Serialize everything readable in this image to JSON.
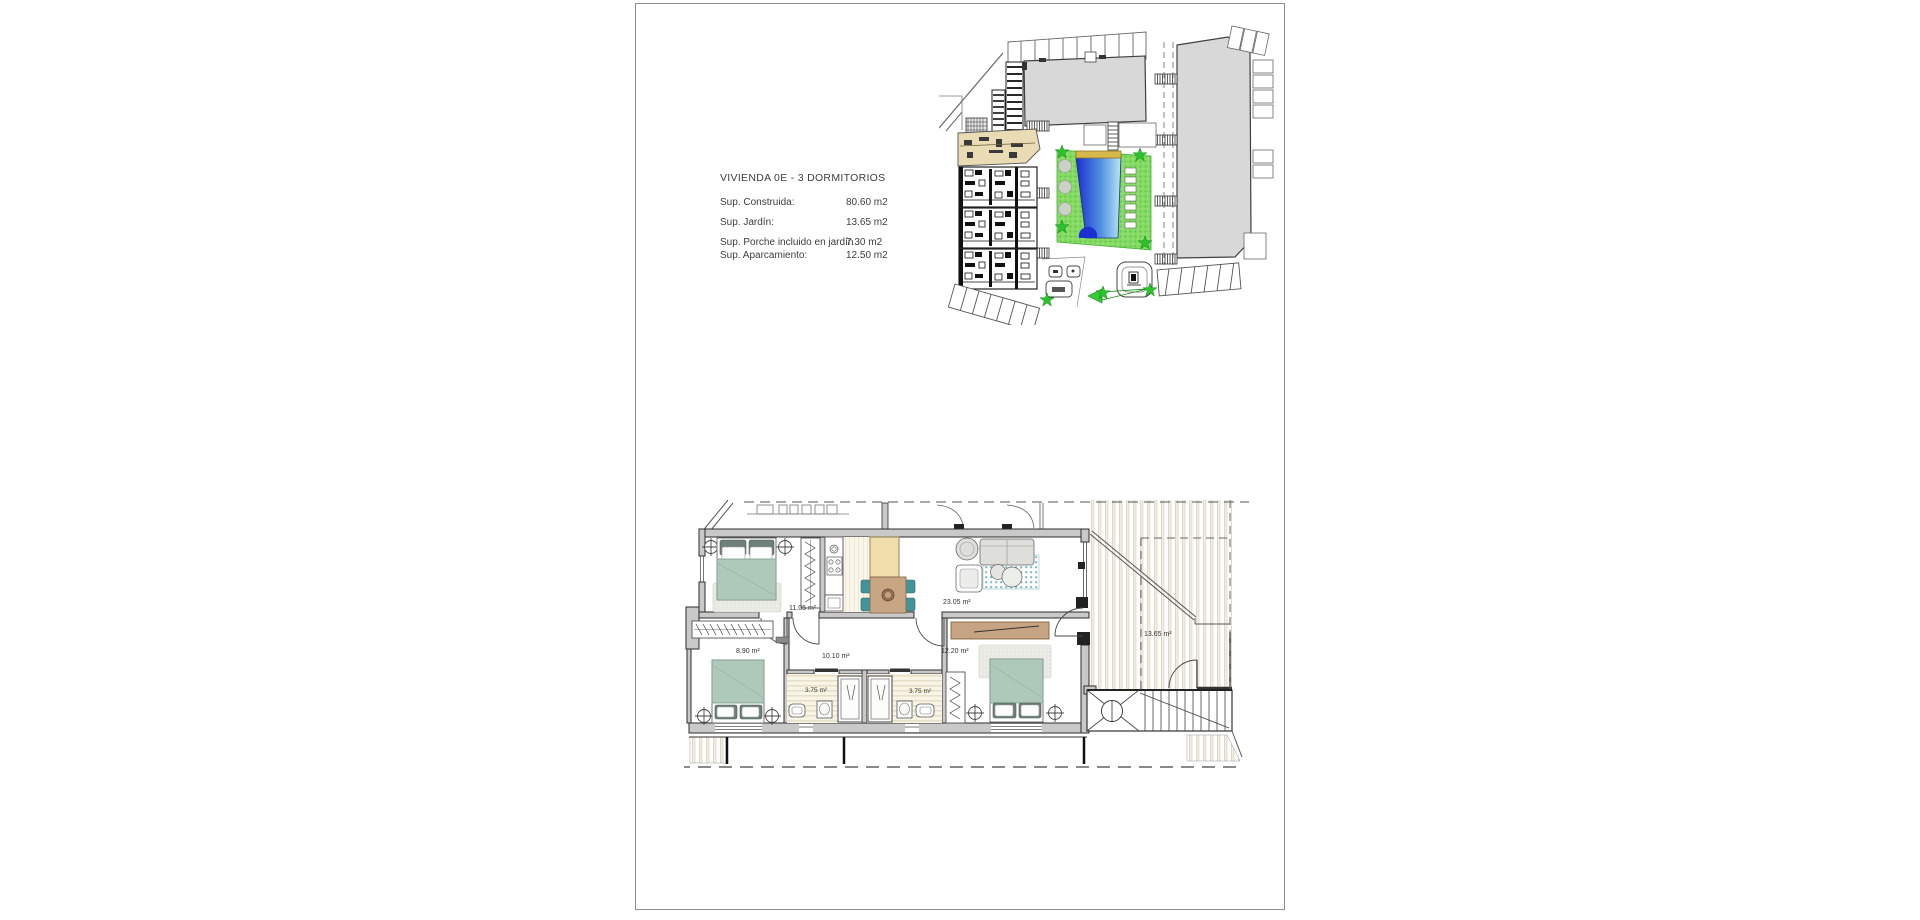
{
  "document": {
    "legend": {
      "title": "VIVIENDA  0E - 3 DORMITORIOS",
      "rows": [
        {
          "label": "Sup. Construida:",
          "value": "80.60 m2"
        },
        {
          "label": "Sup. Jardín:",
          "value": "13.65 m2"
        },
        {
          "label": "Sup. Porche incluido en jardín",
          "value": "7.30 m2"
        },
        {
          "label": "Sup. Aparcamiento:",
          "value": "12.50 m2"
        }
      ]
    },
    "floor_plan": {
      "rooms": [
        {
          "id": "bedroom-1",
          "area_label": "11.05 m²"
        },
        {
          "id": "living-dining-kitchen",
          "area_label": "23.05 m²"
        },
        {
          "id": "bedroom-2",
          "area_label": "8.90 m²"
        },
        {
          "id": "hallway",
          "area_label": "10.10 m²"
        },
        {
          "id": "bathroom-1",
          "area_label": "3.75 m²"
        },
        {
          "id": "bathroom-2",
          "area_label": "3.75 m²"
        },
        {
          "id": "bedroom-3",
          "area_label": "12.20 m²"
        },
        {
          "id": "garden",
          "area_label": "13.65 m²"
        }
      ]
    },
    "colors": {
      "highlight_unit": "#e9dcb4",
      "pool_deep": "#1c2fd0",
      "pool_shallow": "#8ed0f2",
      "landscape_green": "#84da62",
      "building_gray": "#d8d8d8",
      "bed_fabric": "#aec8b9",
      "rug_teal": "#79b7ba",
      "wood": "#c6a383",
      "island_beige": "#f0dfad",
      "wall_gray": "#c9c9c9"
    }
  }
}
